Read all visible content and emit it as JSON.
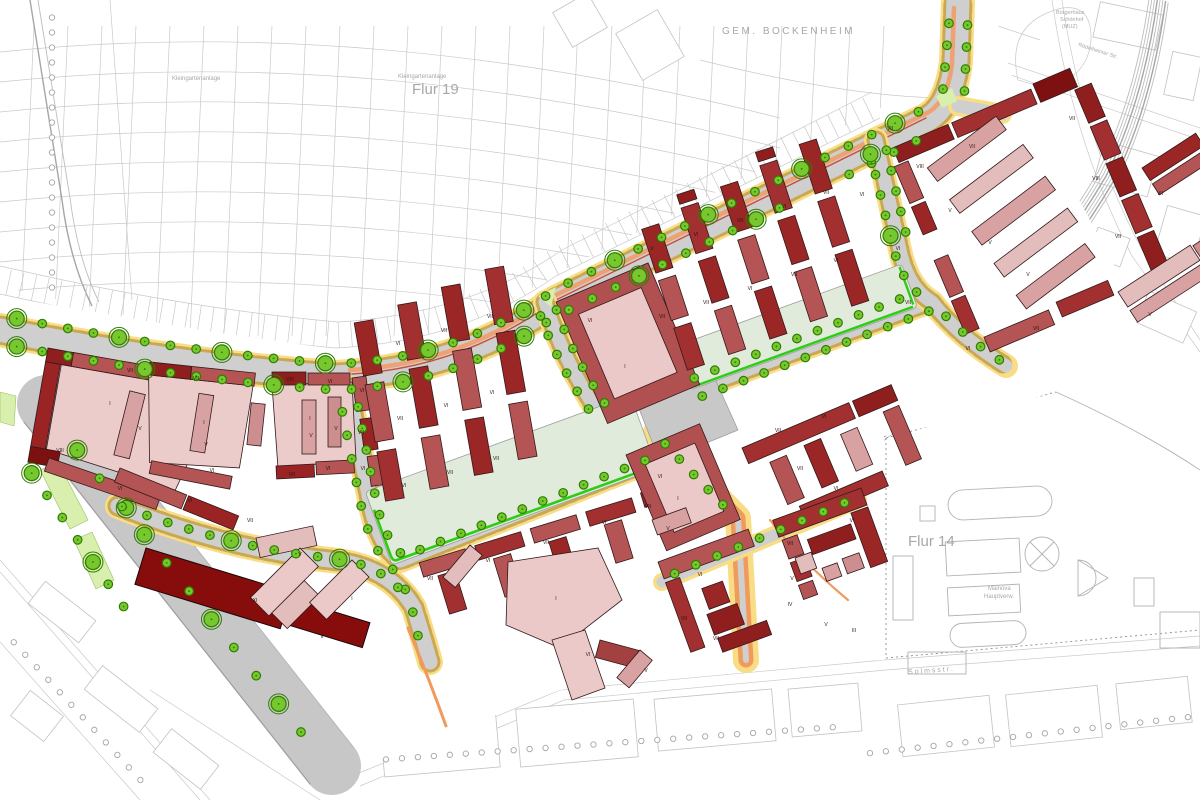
{
  "map_title": "Städtebaulicher Plan Schönhof-Viertel (Bockenheim)",
  "labels": {
    "gem_bockenheim": "GEM. BOCKENHEIM",
    "flur19": "Flur 19",
    "flur14": "Flur 14",
    "kleingarten1": "Kleingartenanlage",
    "kleingarten2": "Kleingartenanlage",
    "solmsstr": "S o l m s s t r .",
    "mainova_lines": [
      "Mainova",
      "Hauptverw."
    ],
    "buergerhaus_lines": [
      "Bürgerhaus",
      "Schönhof",
      "(MUZ)"
    ],
    "roedelheimer": "Rödelheimer Str."
  },
  "palette": {
    "building_dark_red": "#8f1f1f",
    "building_deep_red": "#870d0d",
    "building_red": "#a33030",
    "building_medium_red": "#b45454",
    "building_light_red": "#cc8e8e",
    "building_pink": "#e3bcbc",
    "building_pale_pink": "#ecccca",
    "road_gray": "#cfcfcf",
    "sidewalk_yellow": "#f8dd85",
    "parking_tan": "#c9a854",
    "tram_orange": "#f09a5c",
    "tram_red_line": "#c94f3e",
    "tree_green": "#76c82e",
    "tree_ring_green": "#2f7d00",
    "park_green": "#e0ebdb",
    "park_edge_green": "#2ecc14",
    "median_green": "#d9efae",
    "plaza_gray": "#c8c8c8",
    "cadastral_gray": "#c9c9c9"
  },
  "building_labels": [
    {
      "x": 130,
      "y": 372,
      "t": "VII"
    },
    {
      "x": 60,
      "y": 452,
      "t": "VIII"
    },
    {
      "x": 110,
      "y": 405,
      "t": "I"
    },
    {
      "x": 140,
      "y": 430,
      "t": "V"
    },
    {
      "x": 120,
      "y": 490,
      "t": "VI"
    },
    {
      "x": 196,
      "y": 380,
      "t": "VII"
    },
    {
      "x": 204,
      "y": 424,
      "t": "I"
    },
    {
      "x": 206,
      "y": 446,
      "t": "V"
    },
    {
      "x": 212,
      "y": 472,
      "t": "VI"
    },
    {
      "x": 190,
      "y": 502,
      "t": "VI"
    },
    {
      "x": 250,
      "y": 522,
      "t": "VII"
    },
    {
      "x": 290,
      "y": 381,
      "t": "VIII"
    },
    {
      "x": 330,
      "y": 383,
      "t": "VI"
    },
    {
      "x": 310,
      "y": 420,
      "t": "I"
    },
    {
      "x": 311,
      "y": 437,
      "t": "V"
    },
    {
      "x": 336,
      "y": 430,
      "t": "V"
    },
    {
      "x": 292,
      "y": 476,
      "t": "VII"
    },
    {
      "x": 328,
      "y": 470,
      "t": "VI"
    },
    {
      "x": 362,
      "y": 392,
      "t": "VI"
    },
    {
      "x": 361,
      "y": 434,
      "t": "VII"
    },
    {
      "x": 363,
      "y": 470,
      "t": "VI"
    },
    {
      "x": 398,
      "y": 345,
      "t": "VI"
    },
    {
      "x": 444,
      "y": 332,
      "t": "VII"
    },
    {
      "x": 490,
      "y": 318,
      "t": "VII"
    },
    {
      "x": 400,
      "y": 420,
      "t": "VII"
    },
    {
      "x": 446,
      "y": 407,
      "t": "VI"
    },
    {
      "x": 492,
      "y": 394,
      "t": "VI"
    },
    {
      "x": 404,
      "y": 487,
      "t": "VI"
    },
    {
      "x": 450,
      "y": 474,
      "t": "VII"
    },
    {
      "x": 496,
      "y": 460,
      "t": "VII"
    },
    {
      "x": 590,
      "y": 322,
      "t": "VI"
    },
    {
      "x": 625,
      "y": 368,
      "t": "I"
    },
    {
      "x": 652,
      "y": 250,
      "t": "V"
    },
    {
      "x": 696,
      "y": 236,
      "t": "VI"
    },
    {
      "x": 740,
      "y": 222,
      "t": "VII"
    },
    {
      "x": 784,
      "y": 208,
      "t": "VI"
    },
    {
      "x": 826,
      "y": 194,
      "t": "VII"
    },
    {
      "x": 662,
      "y": 318,
      "t": "VII"
    },
    {
      "x": 706,
      "y": 304,
      "t": "VII"
    },
    {
      "x": 750,
      "y": 290,
      "t": "VI"
    },
    {
      "x": 794,
      "y": 276,
      "t": "VII"
    },
    {
      "x": 836,
      "y": 262,
      "t": "VI"
    },
    {
      "x": 430,
      "y": 580,
      "t": "VII"
    },
    {
      "x": 488,
      "y": 562,
      "t": "VI"
    },
    {
      "x": 546,
      "y": 544,
      "t": "VII"
    },
    {
      "x": 604,
      "y": 524,
      "t": "VI"
    },
    {
      "x": 648,
      "y": 508,
      "t": "VII"
    },
    {
      "x": 660,
      "y": 478,
      "t": "VI"
    },
    {
      "x": 678,
      "y": 500,
      "t": "I"
    },
    {
      "x": 778,
      "y": 432,
      "t": "VII"
    },
    {
      "x": 824,
      "y": 418,
      "t": "VI"
    },
    {
      "x": 800,
      "y": 470,
      "t": "VII"
    },
    {
      "x": 836,
      "y": 490,
      "t": "VI"
    },
    {
      "x": 700,
      "y": 576,
      "t": "VI"
    },
    {
      "x": 684,
      "y": 620,
      "t": "VII"
    },
    {
      "x": 716,
      "y": 640,
      "t": "VII"
    },
    {
      "x": 790,
      "y": 545,
      "t": "VII"
    },
    {
      "x": 792,
      "y": 580,
      "t": "V"
    },
    {
      "x": 790,
      "y": 606,
      "t": "IV"
    },
    {
      "x": 852,
      "y": 522,
      "t": "VI"
    },
    {
      "x": 826,
      "y": 626,
      "t": "V"
    },
    {
      "x": 854,
      "y": 632,
      "t": "III"
    },
    {
      "x": 920,
      "y": 168,
      "t": "VIII"
    },
    {
      "x": 972,
      "y": 148,
      "t": "VII"
    },
    {
      "x": 950,
      "y": 212,
      "t": "V"
    },
    {
      "x": 990,
      "y": 244,
      "t": "V"
    },
    {
      "x": 1028,
      "y": 276,
      "t": "V"
    },
    {
      "x": 1072,
      "y": 120,
      "t": "VII"
    },
    {
      "x": 1096,
      "y": 180,
      "t": "VIII"
    },
    {
      "x": 1118,
      "y": 238,
      "t": "VII"
    },
    {
      "x": 898,
      "y": 250,
      "t": "VI"
    },
    {
      "x": 908,
      "y": 304,
      "t": "VII"
    },
    {
      "x": 968,
      "y": 350,
      "t": "VI"
    },
    {
      "x": 1036,
      "y": 330,
      "t": "VII"
    },
    {
      "x": 1160,
      "y": 195,
      "t": "VII"
    },
    {
      "x": 1150,
      "y": 316,
      "t": "V"
    },
    {
      "x": 255,
      "y": 602,
      "t": "XI"
    },
    {
      "x": 352,
      "y": 600,
      "t": "I"
    },
    {
      "x": 322,
      "y": 638,
      "t": "II"
    },
    {
      "x": 556,
      "y": 600,
      "t": "I"
    },
    {
      "x": 300,
      "y": 556,
      "t": "V"
    },
    {
      "x": 668,
      "y": 530,
      "t": "V"
    },
    {
      "x": 588,
      "y": 656,
      "t": "VI"
    },
    {
      "x": 646,
      "y": 672,
      "t": "V"
    },
    {
      "x": 890,
      "y": 130,
      "t": "VII"
    },
    {
      "x": 862,
      "y": 196,
      "t": "VI"
    }
  ]
}
